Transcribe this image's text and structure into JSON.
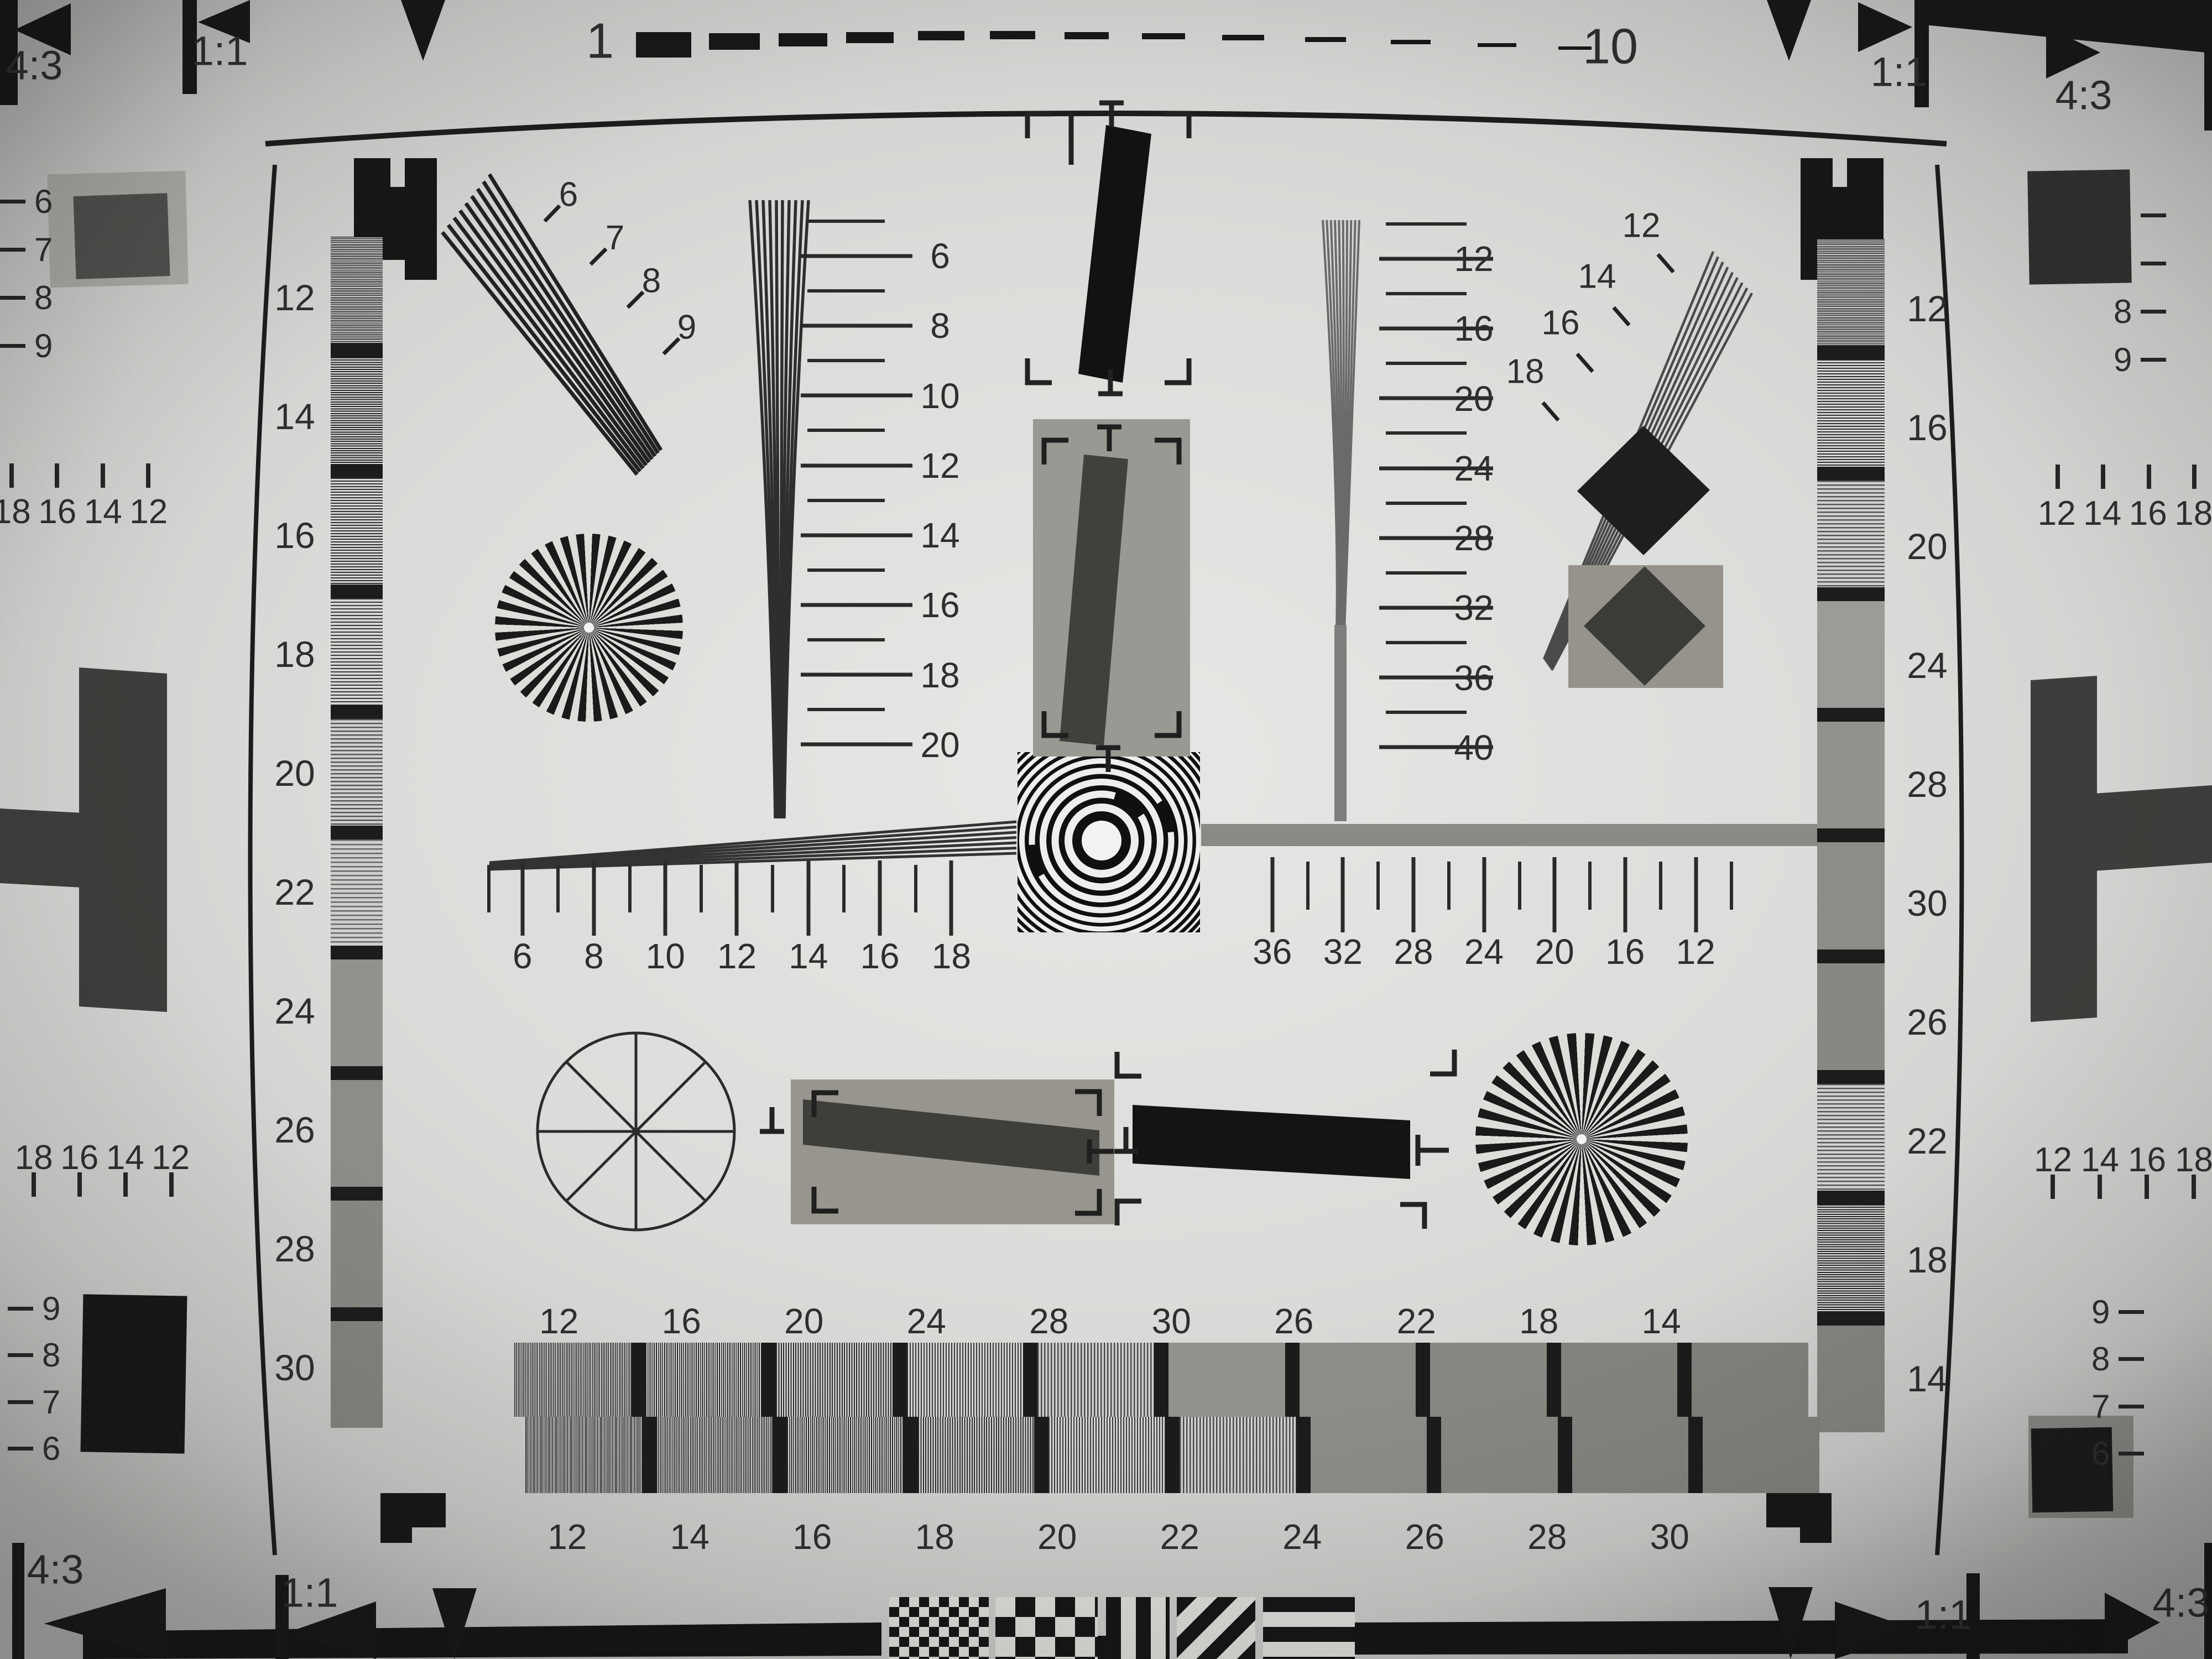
{
  "corners": {
    "top_left": {
      "aspect_label": "4:3",
      "square_label": "1:1"
    },
    "top_right": {
      "aspect_label": "4:3",
      "square_label": "1:1"
    },
    "bottom_left": {
      "aspect_label": "4:3",
      "square_label": "1:1"
    },
    "bottom_right": {
      "aspect_label": "4:3",
      "square_label": "1:1"
    }
  },
  "top_ruler": {
    "left_number": "1",
    "right_number": "10"
  },
  "grayscale_left_labels": [
    "12",
    "14",
    "16",
    "18",
    "20",
    "22",
    "24",
    "26",
    "28",
    "30"
  ],
  "grayscale_right_labels": [
    "12",
    "16",
    "20",
    "24",
    "28",
    "30",
    "26",
    "22",
    "18",
    "14"
  ],
  "edge_left": {
    "top_numbers": [
      "6",
      "7",
      "8",
      "9"
    ],
    "upper_tick_numbers": [
      "18",
      "16",
      "14",
      "12"
    ],
    "lower_tick_numbers": [
      "18",
      "16",
      "14",
      "12"
    ],
    "bottom_numbers": [
      "9",
      "8",
      "7",
      "6"
    ]
  },
  "edge_right": {
    "top_numbers": [
      "6",
      "7",
      "8",
      "9"
    ],
    "upper_tick_numbers": [
      "12",
      "14",
      "16",
      "18"
    ],
    "lower_tick_numbers": [
      "12",
      "14",
      "16",
      "18"
    ],
    "bottom_numbers": [
      "9",
      "8",
      "7",
      "6"
    ]
  },
  "fan_top_left_numbers": [
    "6",
    "7",
    "8",
    "9"
  ],
  "fan_top_right_numbers": [
    "12",
    "14",
    "16",
    "18"
  ],
  "wedge_scale_left_numbers": [
    "6",
    "8",
    "10",
    "12",
    "14",
    "16",
    "18",
    "20"
  ],
  "wedge_scale_right_numbers": [
    "12",
    "16",
    "20",
    "24",
    "28",
    "32",
    "36",
    "40"
  ],
  "horizontal_scale_left_numbers": [
    "6",
    "8",
    "10",
    "12",
    "14",
    "16",
    "18"
  ],
  "horizontal_scale_right_numbers": [
    "36",
    "32",
    "28",
    "24",
    "20",
    "16",
    "12"
  ],
  "bottom_wedge": {
    "upper_labels": [
      "12",
      "16",
      "20",
      "24",
      "28",
      "30",
      "26",
      "22",
      "18",
      "14"
    ],
    "lower_labels": [
      "12",
      "14",
      "16",
      "18",
      "20",
      "22",
      "24",
      "26",
      "28",
      "30"
    ]
  },
  "colors": {
    "paper": "#dadcd9",
    "ink": "#1a1a1a",
    "mid_gray": "#98968f",
    "dark_gray": "#3e403c"
  }
}
